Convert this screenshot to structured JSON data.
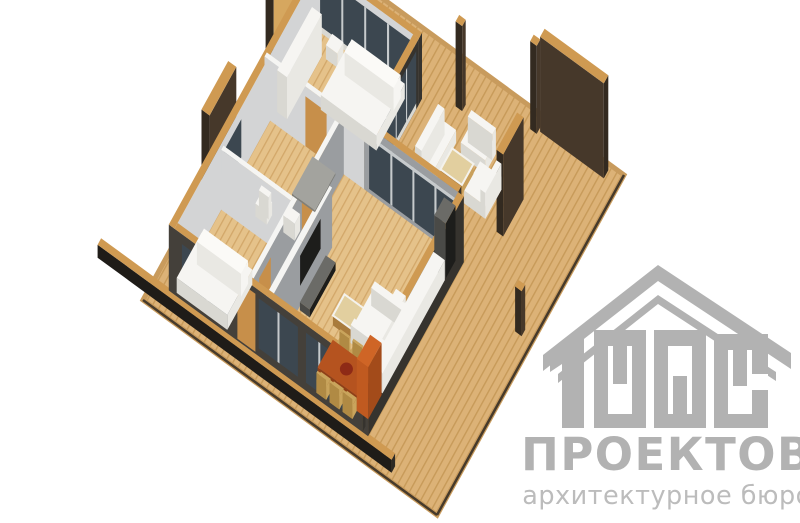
{
  "page": {
    "background": "#ffffff"
  },
  "watermark": {
    "number": "1000",
    "title": "ПРОЕКТОВ",
    "subtitle": "архитектурное бюро"
  },
  "scene": {
    "type": "3d-floorplan-render",
    "rooms": [
      "bedroom-top",
      "bathroom",
      "bedroom-left",
      "living-dining-kitchen",
      "hallway",
      "terrace"
    ]
  },
  "colors": {
    "bg": "#ffffff",
    "deck_base": "#dcb277",
    "deck_stripe": "#c79a59",
    "deck_edge": "#c89b5d",
    "deck_edge_dark": "#463a2b",
    "rail_dark": "#2e2a24",
    "rail_side": "#1f1c18",
    "floor_base": "#e5c28a",
    "floor_stripe": "#d2a769",
    "wood_cap": "#cf9a52",
    "wood_cap_dark": "#a97b3c",
    "panel_tan": "#d6a75f",
    "panel_dark": "#46382a",
    "panel_darker": "#332a20",
    "ext_dark": "#44403a",
    "ext_darker": "#36332e",
    "int_light": "#d3d4d5",
    "int_mid": "#9a9da0",
    "int_top": "#f5f5f3",
    "glass": "#3c4750",
    "mullion": "#c6cacc",
    "door_tan": "#c78f4a",
    "white_hi": "#f6f5f2",
    "white_side": "#d9d8d2",
    "white_side2": "#e9e8e3",
    "pillow_top": "#fbfaf7",
    "gray_dark": "#4a4a47",
    "gray_mid": "#6b6b67",
    "shower_side": "#7f7f7a",
    "shower_top": "#a3a39e",
    "tv_black": "#1d1d1b",
    "table_orange": "#b5531f",
    "table_orange_dark": "#8f3f16",
    "accent_red": "#8e2a16",
    "chair_tan": "#c9a45c",
    "chair_tan_dark": "#b08a44",
    "wood_table": "#c9a05c",
    "wood_table_top": "#e2cf9f",
    "counter_orange": "#c05a20",
    "counter_orange_dark": "#a34b1a",
    "counter_orange_top": "#cf6526",
    "logo_gray": "#b2b2b2",
    "logo_sub": "#bcbcbc"
  }
}
